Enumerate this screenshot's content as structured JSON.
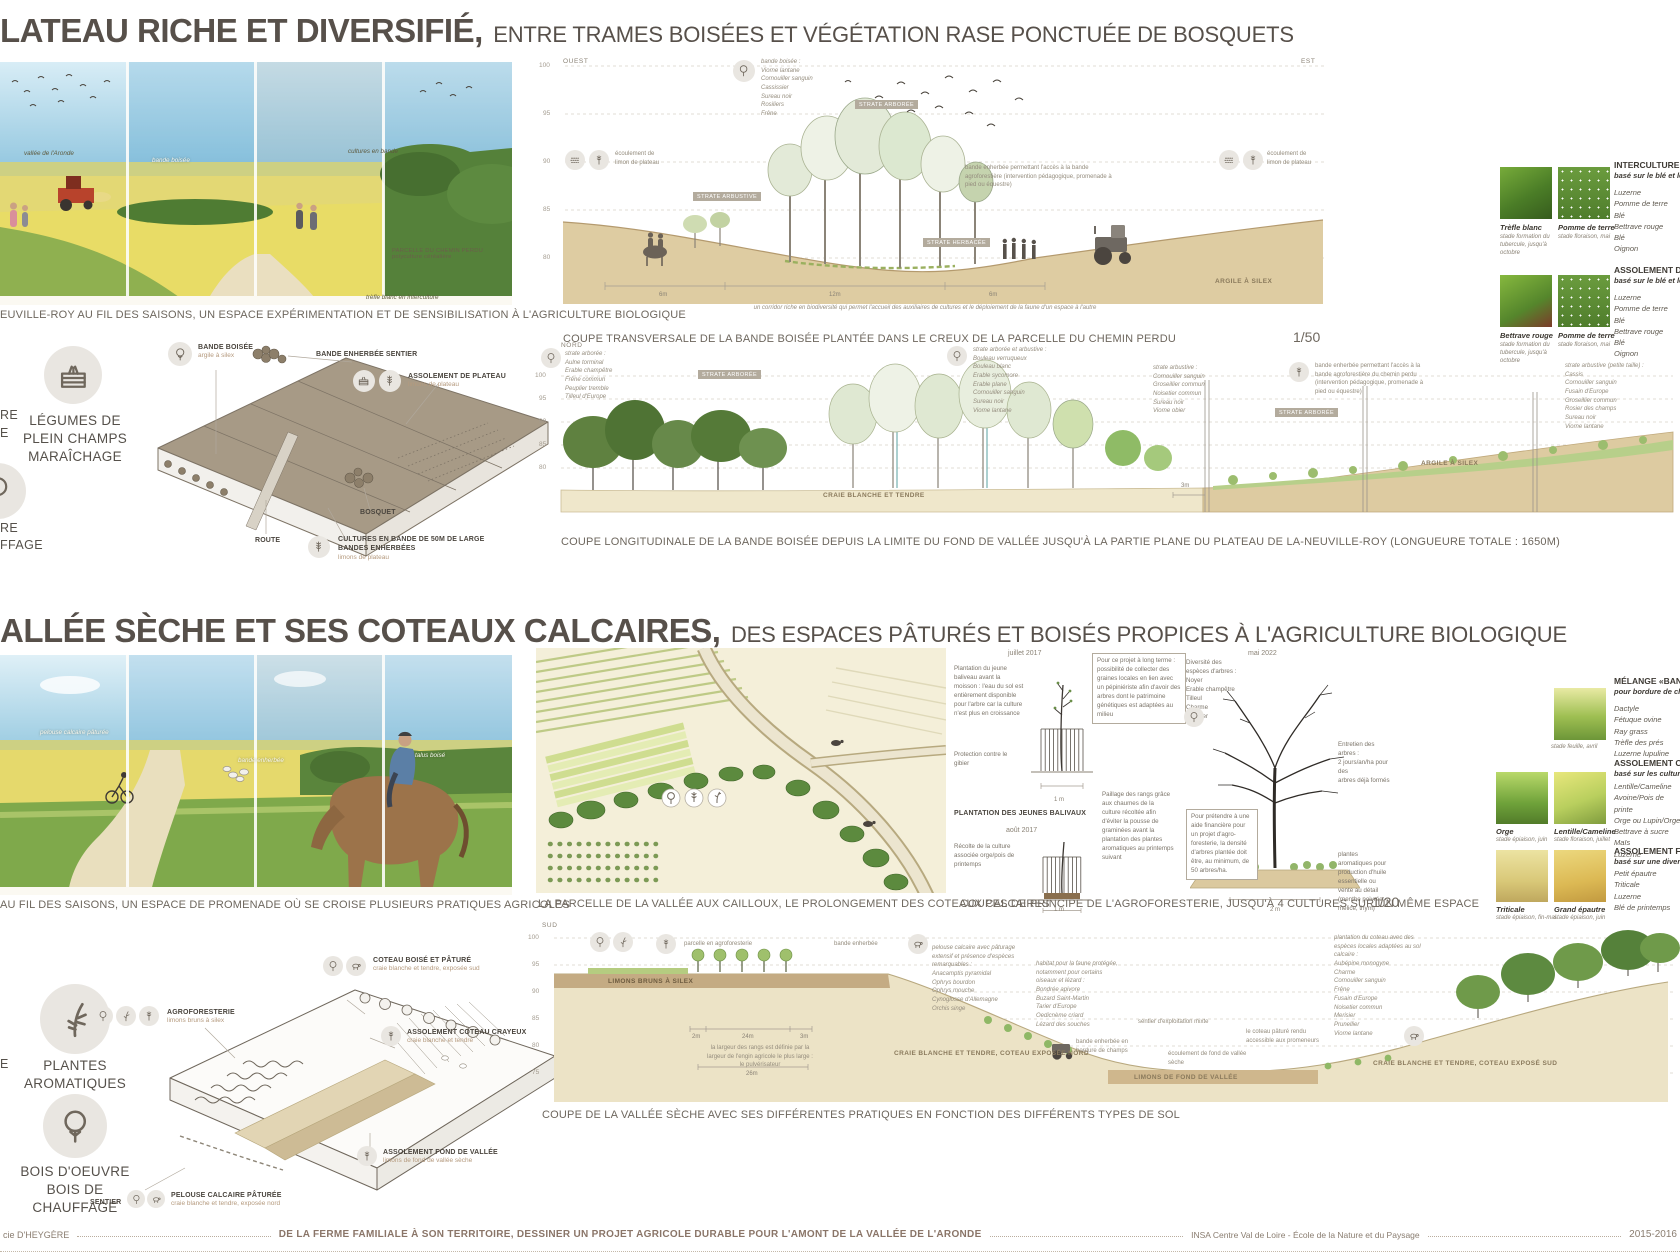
{
  "palette": {
    "ink": "#57504a",
    "caption": "#6e675e",
    "tan": "#b59a7e",
    "soil_beige": "#decca2",
    "craie": "#ece3c6",
    "green_dark": "#55813a",
    "green_light": "#a9c468",
    "sky_blue": "#8cc3dd",
    "block_taupe": "#a79a86"
  },
  "s1": {
    "title": "LATEAU RICHE ET DIVERSIFIÉ",
    "comma": ",",
    "subtitle": "ENTRE TRAMES BOISÉES ET VÉGÉTATION RASE PONCTUÉE DE BOSQUETS",
    "pano": {
      "caption": "EUVILLE-ROY AU FIL DES SAISONS, UN ESPACE EXPÉRIMENTATION ET DE SENSIBILISATION À L'AGRICULTURE BIOLOGIQUE",
      "a1": "vallée de l'Aronde",
      "a2": "bande boisée",
      "a3": "cultures en bande",
      "a4": "PARCELLE DU CHEMIN PERDU\npolyculture céréalière",
      "a5": "trèfle blanc en interculture"
    },
    "legend": {
      "frag1": "RE",
      "frag2": "E",
      "item1": "LÉGUMES DE\nPLEIN CHAMPS\nMARAÎCHAGE",
      "frag3": "RE",
      "frag4": "FFAGE"
    },
    "axo": {
      "l1": "BANDE BOISÉE",
      "l1s": "argile à silex",
      "l2": "BANDE ENHERBÉE SENTIER",
      "l3": "ASSOLEMENT DE PLATEAU",
      "l3s": "limons de plateau",
      "l4": "ROUTE",
      "l5": "BOSQUET",
      "l6": "CULTURES EN BANDE DE 50M DE LARGE\nBANDES ENHERBÉES",
      "l6s": "limons de plateau"
    },
    "c1": {
      "west": "OUEST",
      "east": "EST",
      "ax": {
        "a": "100",
        "b": "95",
        "c": "90",
        "d": "85",
        "e": "80"
      },
      "species": "bande boisée :\nViorne lantane\nCornouiller sanguin\nCassissier\nSureau noir\nRosiliers\nFrêne",
      "tag1": "STRATE ARBORÉE",
      "tag2": "STRATE ARBUSTIVE",
      "tag3": "STRATE HERBACÉE",
      "ecl": "écoulement de\nlimon de plateau",
      "ecr": "écoulement de\nlimon de plateau",
      "bande": "bande enherbée permettant l'accès à la bande agroforestière (intervention pédagogique, promenade à pied ou équestre)",
      "soil": "ARGILE À SILEX",
      "m1": "6m",
      "m2": "12m",
      "m3": "6m",
      "corridor": "un corridor riche en biodiversité qui permet l'accueil des auxiliaires de cultures et le déploiement de la faune d'un espace à l'autre",
      "caption": "COUPE TRANSVERSALE DE LA BANDE BOISÉE PLANTÉE DANS LE CREUX DE LA PARCELLE DU CHEMIN PERDU",
      "scale": "1/50"
    },
    "c2": {
      "dir": "NORD",
      "ax": {
        "a": "100",
        "b": "95",
        "c": "90",
        "d": "85",
        "e": "80"
      },
      "sp1": "strate arborée :\nAulne torminal\nErable champêtre\nFrêne commun\nPeuplier tremble\nTilleul d'Europe",
      "sp2": "strate arborée et arbustive :\nBouleau verruqueux\nBouleau blanc\nErable sycomore\nErable plane\nCornouiller sanguin\nSureau noir\nViorne lantane",
      "sp3": "strate arbustive :\nCornouiller sanguin\nGroseillier commun\nNoisetier commun\nSureau noir\nViorne obier",
      "note": "bande enherbée permettant l'accès à la bande agroforestière du chemin perdu (intervention pédagogique, promenade à pied ou équestre)",
      "sp4": "strate arbustive (petite taille) :\nCassis\nCornouiller sanguin\nFusain d'Europe\nGroseillier commun\nRosier des champs\nSureau noir\nViorne lantane",
      "tag1": "STRATE ARBORÉE",
      "tag2": "STRATE ARBORÉE",
      "m1": "3m",
      "soil1": "CRAIE BLANCHE ET TENDRE",
      "soil2": "ARGILE À SILEX",
      "caption": "COUPE LONGITUDINALE DE LA BANDE BOISÉE DEPUIS LA LIMITE DU FOND DE VALLÉE JUSQU'À LA PARTIE PLANE DU PLATEAU DE LA-NEUVILLE-ROY (LONGUEURE TOTALE : 1650M)"
    },
    "lr": {
      "b1h": "INTERCULTURE",
      "b1s": "basé sur le blé et les",
      "b1i": "Luzerne\nPomme de terre\nBlé\nBettrave rouge\nBlé\nOignon",
      "p1n": "Trèfle blanc",
      "p1s": "stade formation du\ntubercule, jusqu'à\noctobre",
      "p2n": "Pomme de terre",
      "p2s": "stade floraison, mai",
      "b2h": "ASSOLEMENT DE P",
      "b2s": "basé sur le blé et les",
      "b2i": "Luzerne\nPomme de terre\nBlé\nBettrave rouge\nBlé\nOignon",
      "p3n": "Bettrave rouge",
      "p3s": "stade formation du\ntubercule, jusqu'à\noctobre",
      "p4n": "Pomme de terre",
      "p4s": "stade floraison, mai"
    }
  },
  "s2": {
    "title": "ALLÉE SÈCHE ET SES COTEAUX CALCAIRES",
    "comma": ",",
    "subtitle": "DES ESPACES PÂTURÉS ET BOISÉS PROPICES À L'AGRICULTURE BIOLOGIQUE",
    "pano": {
      "caption": "AU FIL DES SAISONS, UN ESPACE DE PROMENADE OÙ SE CROISE PLUSIEURS PRATIQUES AGRICOLES",
      "a1": "pelouse calcaire pâturée",
      "a2": "bande enherbée",
      "a3": "talus boisé"
    },
    "legend": {
      "frag1": "E",
      "item1": "PLANTES\nAROMATIQUES",
      "item2": "BOIS D'OEUVRE\nBOIS DE CHAUFFAGE"
    },
    "axo": {
      "l1": "AGROFORESTERIE",
      "l1s": "limons bruns à silex",
      "l2": "COTEAU BOISÉ ET PÂTURÉ",
      "l2s": "craie blanche et tendre, exposée sud",
      "l3": "ASSOLEMENT COTEAU CRAYEUX",
      "l3s": "craie blanche et tendre",
      "l4": "ASSOLEMENT FOND DE VALLÉE",
      "l4s": "limons de fond de vallée sèche",
      "l5": "SENTIER",
      "l6": "PELOUSE CALCAIRE PÂTURÉE",
      "l6s": "craie blanche et tendre, exposée nord"
    },
    "plan": {
      "caption": "LA PARCELLE DE LA VALLÉE AUX CAILLOUX, LE PROLONGEMENT DES COTEAUX CALCAIRES"
    },
    "agro": {
      "d1": "juillet 2017",
      "d2": "août 2017",
      "d3": "mai 2022",
      "n1": "Plantation du jeune baliveau avant la moisson : l'eau du sol est entièrement disponible pour l'arbre car la culture n'est plus en croissance",
      "n2": "Protection contre le gibier",
      "lb": "PLANTATION DES JEUNES BALIVAUX",
      "n3": "Pour ce projet à long terme : possibilité de collecter des graines locales en lien avec un pépiniériste afin d'avoir des arbres dont le patrimoine génétiques est adaptées au milieu",
      "n4": "Diversité des espèces d'arbres :\nNoyer\nErable champêtre\nTilleul\nCharme\nMerisier",
      "n5": "Entretien des arbres :\n2 jours/an/ha pour des\narbres déjà formés",
      "n6": "Récolte de la culture associée orge/pois de printemps",
      "n7": "Paillage des rangs grâce aux chaumes de la culture récoltée afin d'éviter la pousse de graminées avant la plantation des plantes aromatiques au printemps suivant",
      "n8": "Pour prétendre à une aide financière pour un projet d'agro-foresterie, la densité d'arbres plantée doit être, au minimum, de 50 arbres/ha.",
      "n9": "plantes aromatiques pour production d'huile essentielle ou vente au détail (menthe poivrée, mélice, thym)",
      "m1": "1 m",
      "m2": "1 m",
      "m3": "2 m",
      "caption": "COUPES DE PRINCIPE DE L'AGROFORESTERIE, JUSQU'À 4 CULTURES SUR UN MÊME ESPACE",
      "scale": "1/20"
    },
    "c3": {
      "dir": "SUD",
      "ax": {
        "a": "100",
        "b": "95",
        "c": "90",
        "d": "85",
        "e": "80",
        "f": "75"
      },
      "a1": "parcelle en agroforesterie",
      "a2": "bande enherbée",
      "a3": "pelouse calcaire avec pâturage extensif et présence d'espèces remarquables :\nAnacamptis pyramidal\nOphrys bourdon\nOphrys mouche\nCynoglosse d'Allemagne\nOrchis singe",
      "a4": "habitat pour la faune protégée, notamment pour certains oiseaux et lézard :\nBondrée apivore\nBuzard Saint-Martin\nTarier d'Europe\nOedicnème criard\nLézard des souches",
      "a5": "sentier d'exploitation mixte",
      "a6": "bande enherbée en bordure de champs",
      "a7": "écoulement de fond de vallée sèche",
      "a8": "le coteau pâturé rendu accessible aux promeneurs",
      "a9": "plantation du coteau avec des espèces locales adaptées au sol calcaire :\nAubépine monogyne\nCharme\nCornouiller sanguin\nFrêne\nFusain d'Europe\nNoisetier commun\nMerisier\nPrunellier\nViorne lantane",
      "soil1": "LIMONS BRUNS À SILEX",
      "soil2": "CRAIE BLANCHE ET TENDRE, COTEAU EXPOSÉE NORD",
      "soil3": "LIMONS DE FOND DE VALLÉE",
      "soil4": "CRAIE BLANCHE ET TENDRE, COTEAU EXPOSÉ SUD",
      "m1": "2m",
      "m2": "24m",
      "m3": "3m",
      "m4": "26m",
      "n1": "la largeur des rangs est définie par la largeur de l'engin agricole le plus large : le pulvérisateur",
      "caption": "COUPE DE LA VALLÉE SÈCHE AVEC SES DIFFÉRENTES PRATIQUES EN FONCTION DES DIFFÉRENTS TYPES DE SOL"
    },
    "lr": {
      "b1h": "MÉLANGE «BANDE",
      "b1s": "pour bordure de cha",
      "b1i": "Dactyle\nFétuque ovine\nRay grass\nTrèfle des prés\nLuzerne lupuline",
      "p1s": "stade feuille, avril",
      "b2h": "ASSOLEMENT COTE",
      "b2s": "basé sur les cultures",
      "b2i": "Lentille/Cameline\nAvoine/Pois de printe\nOrge ou Lupin/Orge\nBettrave à sucre\nMaïs\nLuzerne",
      "p2n": "Orge",
      "p2s": "stade épiaison, juin",
      "p3n": "Lentille/Cameline",
      "p3s": "stade floraison, juillet",
      "b3h": "ASSOLEMENT FON",
      "b3s": "basé sur une diversit",
      "b3i": "Petit épautre\nTriticale\nLuzerne\nBlé de printemps",
      "p4n": "Triticale",
      "p4s": "stade épiaison, fin-mai",
      "p5n": "Grand épautre",
      "p5s": "stade épiaison, juin"
    }
  },
  "footer": {
    "left": "cie D'HEYGÈRE",
    "center": "DE LA FERME FAMILIALE À SON TERRITOIRE, DESSINER UN PROJET AGRICOLE DURABLE POUR L'AMONT DE LA VALLÉE DE L'ARONDE",
    "school": "INSA Centre Val de Loire - École de la Nature et du Paysage",
    "year": "2015-2016"
  }
}
